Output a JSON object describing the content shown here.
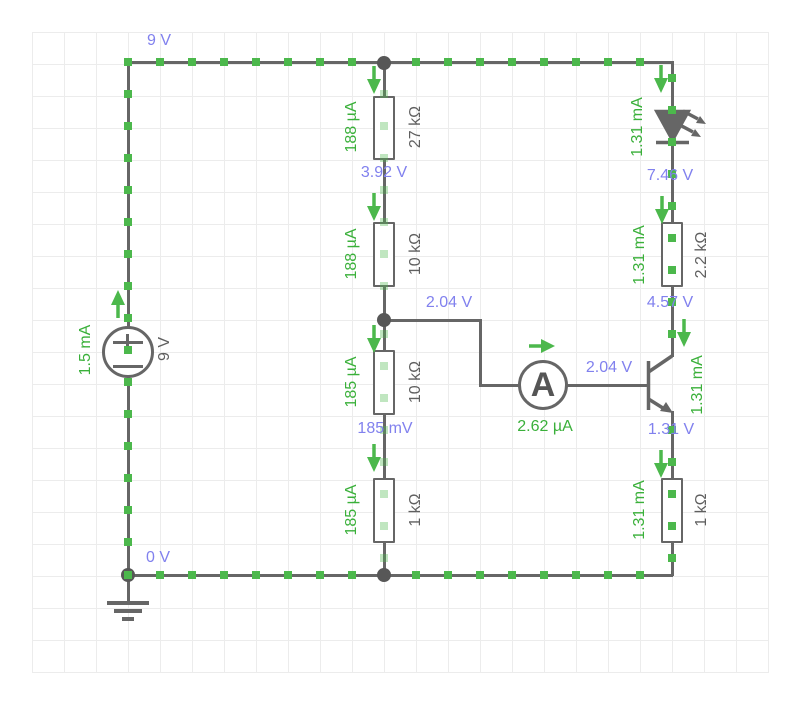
{
  "app": {
    "type": "circuit-simulator-canvas"
  },
  "colors": {
    "bg": "#ffffff",
    "grid": "#ececec",
    "wire": "#666666",
    "node": "#575757",
    "current": "#4cb84c",
    "current_text": "#3ab03a",
    "voltage": "#8181ee",
    "comp": "#5f5f5f"
  },
  "nodes": {
    "top_rail": "9 V",
    "bottom_rail": "0 V",
    "divider_upper": "3.92 V",
    "divider_tap": "2.04 V",
    "base_wire": "2.04 V",
    "below_lower_divider": "185 mV",
    "led_cathode": "7.46 V",
    "collector": "4.57 V",
    "emitter": "1.31 V"
  },
  "components": {
    "source": {
      "label": "9 V",
      "current": "1.5 mA"
    },
    "r27k": {
      "label": "27 kΩ",
      "current": "188 µA"
    },
    "r10k_upper": {
      "label": "10 kΩ",
      "current": "188 µA"
    },
    "r10k_lower": {
      "label": "10 kΩ",
      "current": "185 µA"
    },
    "r1k_left": {
      "label": "1 kΩ",
      "current": "185 µA"
    },
    "led": {
      "current": "1.31 mA"
    },
    "r2200": {
      "label": "2.2 kΩ",
      "current": "1.31 mA"
    },
    "transistor": {
      "emitter_current": "1.31 mA"
    },
    "r1k_right": {
      "label": "1 kΩ",
      "current": "1.31 mA"
    },
    "ammeter": {
      "symbol": "A",
      "reading": "2.62 µA"
    }
  }
}
